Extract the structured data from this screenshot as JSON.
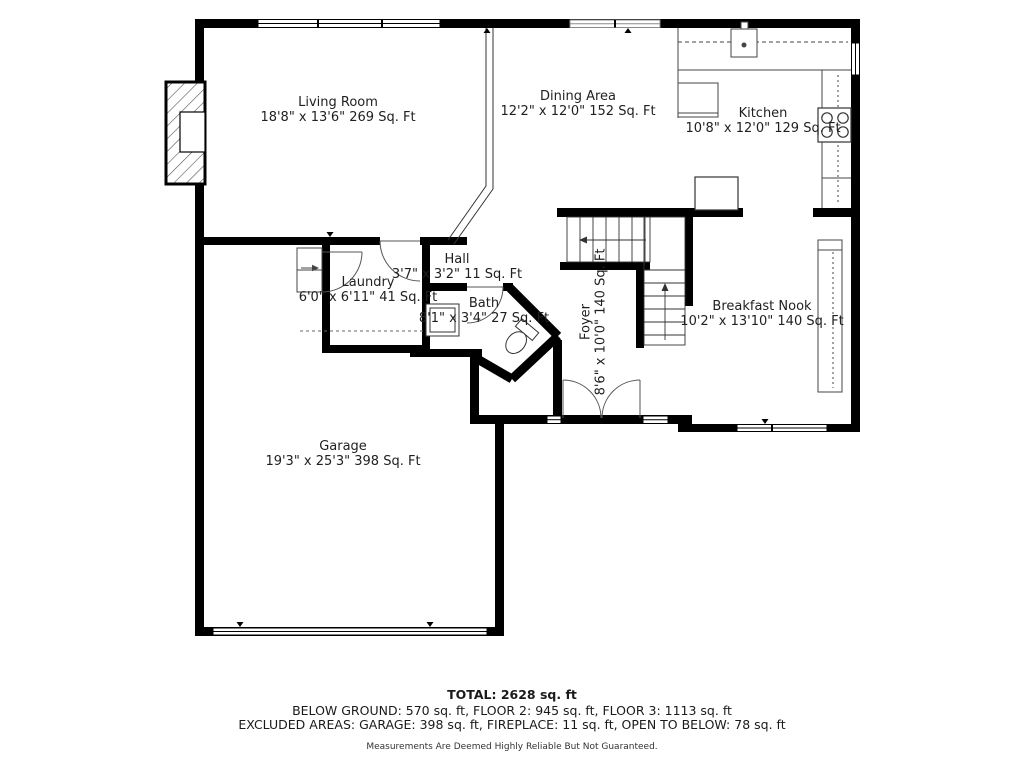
{
  "floorplan": {
    "rooms": [
      {
        "name": "Living Room",
        "dims": "18'8\" x 13'6\" 269 Sq. Ft"
      },
      {
        "name": "Dining Area",
        "dims": "12'2\" x 12'0\" 152 Sq. Ft"
      },
      {
        "name": "Kitchen",
        "dims": "10'8\" x 12'0\" 129 Sq. Ft"
      },
      {
        "name": "Hall",
        "dims": "3'7\" x 3'2\" 11 Sq. Ft"
      },
      {
        "name": "Laundry",
        "dims": "6'0\" x 6'11\" 41 Sq. Ft"
      },
      {
        "name": "Bath",
        "dims": "8'1\" x 3'4\" 27 Sq. Ft"
      },
      {
        "name": "Foyer",
        "dims": "8'6\" x 10'0\" 140 Sq. Ft"
      },
      {
        "name": "Breakfast Nook",
        "dims": "10'2\" x 13'10\" 140 Sq. Ft"
      },
      {
        "name": "Garage",
        "dims": "19'3\" x 25'3\" 398 Sq. Ft"
      }
    ],
    "fixtures": [
      "fireplace",
      "staircase",
      "kitchen-sink",
      "stove",
      "refrigerator",
      "toilet",
      "bathroom-sink",
      "garage-door",
      "entry-double-door"
    ]
  },
  "summary": {
    "total": "TOTAL: 2628 sq. ft",
    "floors": "BELOW GROUND: 570 sq. ft, FLOOR 2: 945 sq. ft, FLOOR 3: 1113 sq. ft",
    "excluded": "EXCLUDED AREAS: GARAGE: 398 sq. ft, FIREPLACE: 11 sq. ft, OPEN TO BELOW: 78 sq. ft",
    "disclaimer": "Measurements Are Deemed Highly Reliable But Not Guaranteed."
  },
  "colors": {
    "wall": "#000000",
    "background": "#ffffff",
    "text": "#1f1f1f",
    "thin_line": "#444444"
  }
}
